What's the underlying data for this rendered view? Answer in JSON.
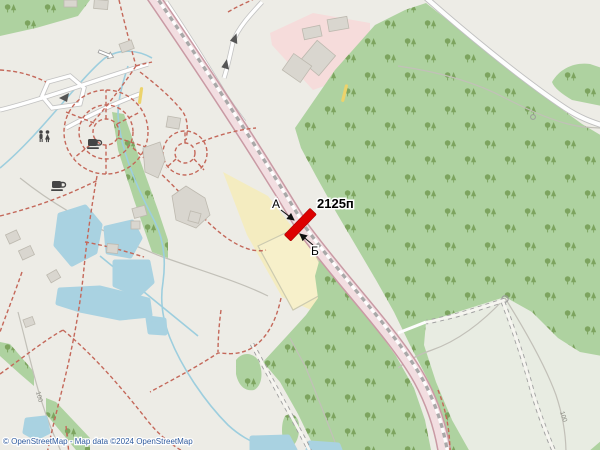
{
  "attribution": {
    "text": "© OpenStreetMap - Map data ©2024 OpenStreetMap"
  },
  "marker": {
    "billboard_id": "2125п",
    "side_a_label": "А",
    "side_b_label": "Б"
  },
  "path_labels": {
    "contour_left": "100",
    "contour_right": "100"
  },
  "icons": {
    "toilets": "toilets-icon",
    "cafe_upper": "cafe-icon",
    "cafe_lower": "cafe-icon",
    "flow_arrow": "water-flow-arrow-icon"
  },
  "colors": {
    "land": "#edece6",
    "forest": "#aed2a0",
    "tree": "#7da45f",
    "clearing": "#e8ece2",
    "water": "#a9d2e1",
    "stream": "#9dcede",
    "road_fill": "#f2dee1",
    "road_casing": "#c99aa4",
    "minor_road_fill": "#ffffff",
    "minor_road_casing": "#c2c2c2",
    "pink_area": "#f6dcdb",
    "field_yellow": "#f4ecc0",
    "field_inner": "#f7f0ca",
    "path_red": "#c4685a",
    "gray_path": "#c2c0b8",
    "building": "#d9d6cf",
    "building_stroke": "#bdb9af",
    "marker_red": "#dd0000",
    "icon_dark": "#454545",
    "attribution_blue": "#2f5b9e",
    "yellow_path": "#ecd36b"
  }
}
